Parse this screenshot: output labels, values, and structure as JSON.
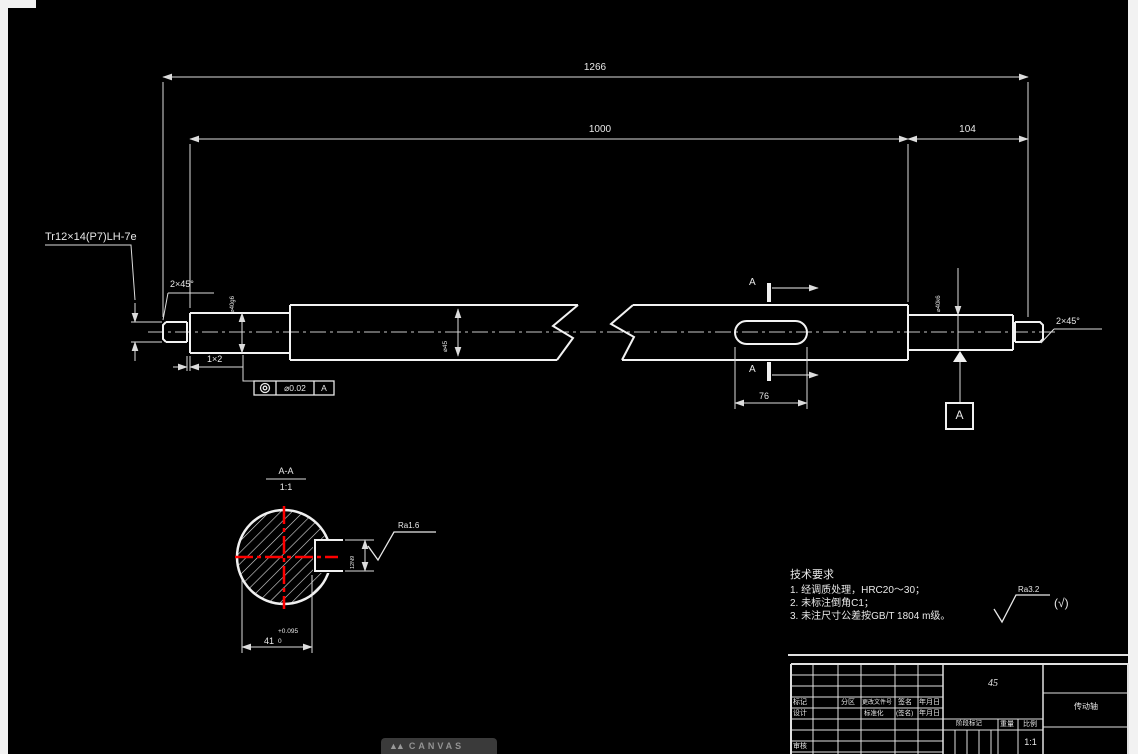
{
  "drawing": {
    "dim_overall": "1266",
    "dim_body": "1000",
    "dim_right_section": "104",
    "thread_callout": "Tr12×14(P7)LH-7e",
    "chamfer_left": "2×45°",
    "chamfer_right": "2×45°",
    "groove": "1×2",
    "dia_left_journal": "⌀40g6",
    "dia_mid": "⌀45",
    "dia_right_journal": "⌀40k6",
    "keyway_length": "76",
    "keyway_width": "12N9",
    "tolerance_frame": {
      "value": "⌀0.02",
      "datum": "A"
    },
    "section_cut_label_top": "A",
    "section_cut_label_bottom": "A",
    "datum_label": "A",
    "section_view": {
      "title": "A-A",
      "scale": "1:1",
      "width_dim": "41",
      "tol_upper": "+0.095",
      "tol_lower": "0",
      "roughness": "Ra1.6"
    },
    "roughness_general": {
      "value": "Ra3.2",
      "suffix": "(√)"
    },
    "tech_req": {
      "title": "技术要求",
      "items": [
        "1.  经调质处理，HRC20～30；",
        "2.  未标注倒角C1；",
        "3.  未注尺寸公差按GB/T 1804 m级。"
      ]
    },
    "title_block": {
      "material": "45",
      "part_name": "传动轴",
      "scale_value": "1:1",
      "labels": {
        "mark": "标记",
        "zone": "分区",
        "change_file_no": "更改文件号",
        "signature": "签名",
        "date": "年月日",
        "design": "设计",
        "standardization": "标准化",
        "signature2": "(签名)",
        "date2": "年月日",
        "review": "审核",
        "stage_mark": "阶段标记",
        "weight": "重量",
        "scale": "比例"
      }
    },
    "watermark": {
      "logo": "▲▲",
      "text": "CANVAS"
    }
  }
}
